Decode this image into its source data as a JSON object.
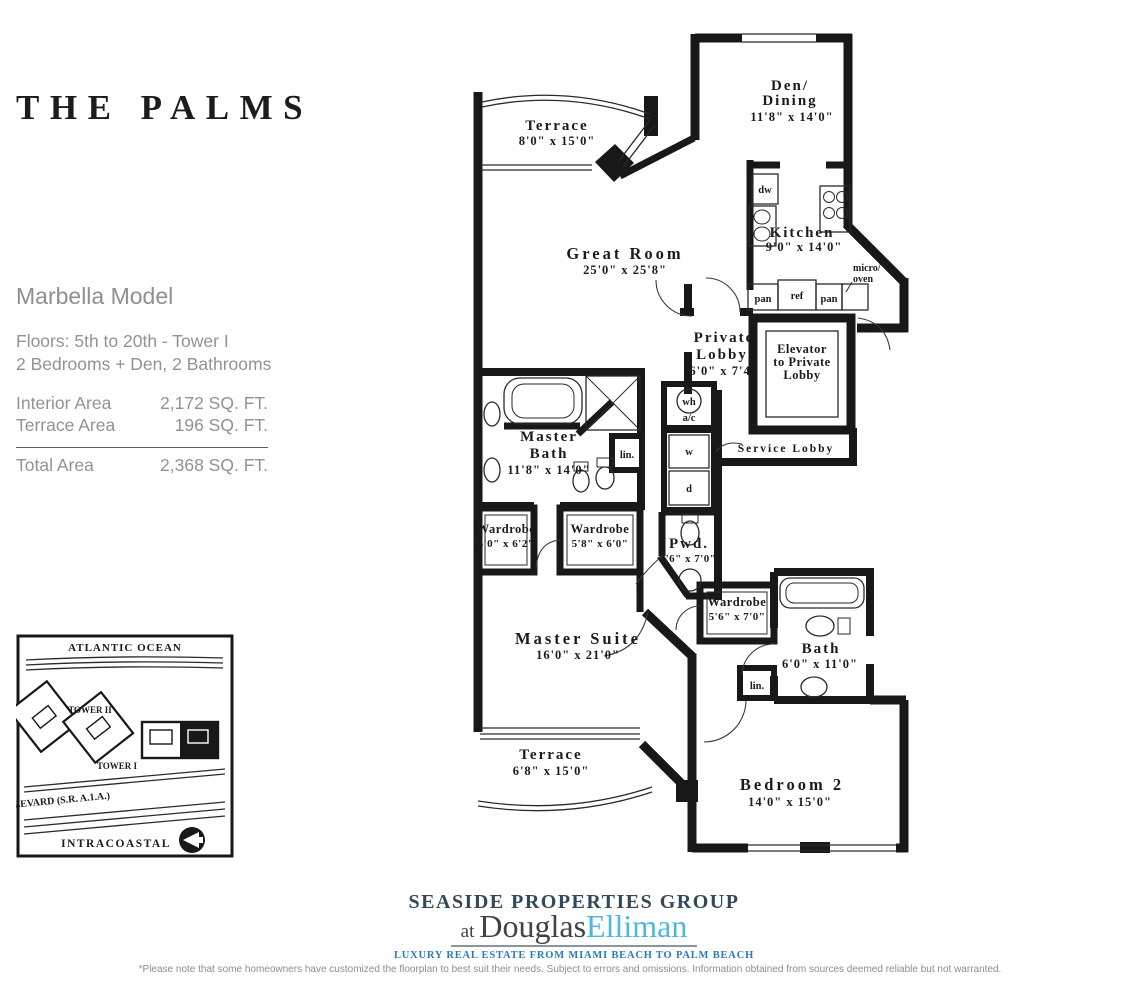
{
  "title": "THE PALMS",
  "model": {
    "name": "Marbella Model",
    "floors": "Floors: 5th to 20th - Tower I",
    "config": "2 Bedrooms + Den, 2 Bathrooms",
    "areas": [
      {
        "label": "Interior Area",
        "value": "2,172 SQ. FT."
      },
      {
        "label": "Terrace Area",
        "value": "196 SQ. FT."
      }
    ],
    "total_label": "Total Area",
    "total_value": "2,368 SQ. FT."
  },
  "sitemap": {
    "ocean_label": "ATLANTIC OCEAN",
    "tower2_label": "TOWER II",
    "tower1_label": "TOWER I",
    "road_label": "OCEAN BOULEVARD  (S.R. A.1.A.)",
    "intracoastal_label": "INTRACOASTAL"
  },
  "floorplan": {
    "rooms": {
      "terrace_top": {
        "name": "Terrace",
        "dims": "8'0\" x 15'0\""
      },
      "den": {
        "line1": "Den/",
        "line2": "Dining",
        "dims": "11'8\" x 14'0\""
      },
      "great_room": {
        "name": "Great Room",
        "dims": "25'0\" x 25'8\""
      },
      "kitchen": {
        "name": "Kitchen",
        "dims": "9'0\" x 14'0\""
      },
      "private_lobby": {
        "line1": "Private",
        "line2": "Lobby",
        "dims": "6'0\" x 7'4\""
      },
      "elevator": {
        "line1": "Elevator",
        "line2": "to Private",
        "line3": "Lobby"
      },
      "service_lobby": {
        "name": "Service Lobby"
      },
      "master_bath": {
        "line1": "Master",
        "line2": "Bath",
        "dims": "11'8\" x 14'0\""
      },
      "wardrobe_a": {
        "name": "Wardrobe",
        "dims": "4'0\" x 6'2\""
      },
      "wardrobe_b": {
        "name": "Wardrobe",
        "dims": "5'8\" x 6'0\""
      },
      "powder": {
        "name": "Pwd.",
        "dims": "3'6\" x 7'0\""
      },
      "master_suite": {
        "name": "Master Suite",
        "dims": "16'0\" x 21'0\""
      },
      "wardrobe_c": {
        "name": "Wardrobe",
        "dims": "5'6\" x 7'0\""
      },
      "bath2": {
        "name": "Bath",
        "dims": "6'0\" x 11'0\""
      },
      "terrace_bottom": {
        "name": "Terrace",
        "dims": "6'8\" x 15'0\""
      },
      "bedroom2": {
        "name": "Bedroom 2",
        "dims": "14'0\" x 15'0\""
      }
    },
    "fixtures": {
      "dw": "dw",
      "ref": "ref",
      "pan": "pan",
      "micro1": "micro/",
      "micro2": "oven",
      "wh": "wh",
      "ac": "a/c",
      "washer": "w",
      "dryer": "d",
      "linen": "lin."
    }
  },
  "footer": {
    "brand_line": "SEASIDE PROPERTIES GROUP",
    "brand_at": "at",
    "brand_name_dark": "Douglas",
    "brand_name_light": "Elliman",
    "tagline": "LUXURY REAL ESTATE FROM MIAMI BEACH TO PALM BEACH",
    "disclaimer": "*Please note that some homeowners have customized the floorplan to best suit their needs. Subject to errors and omissions. Information obtained from sources deemed reliable but not warranted."
  },
  "colors": {
    "ink": "#1b1b1b",
    "text_gray": "#8f8f8f",
    "brand_dark": "#32495c",
    "elliman_blue": "#4cb8e0",
    "tagline_blue": "#2a7ab8"
  }
}
